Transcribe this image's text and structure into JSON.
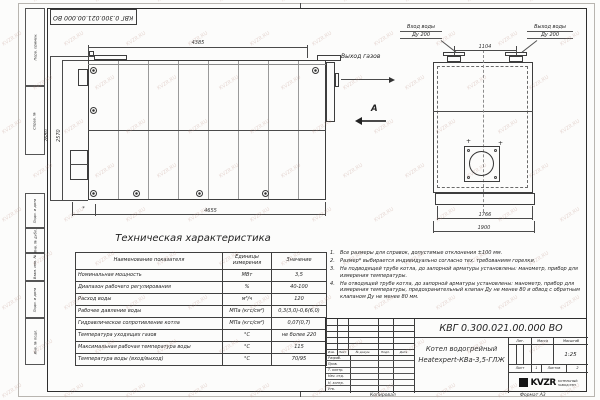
{
  "watermark": "KVZR.RU",
  "frame": {
    "margin_stamps": [
      "Перв. примен.",
      "Справ. №",
      "Подп. и дата",
      "Инв. № дубл.",
      "Взам. инв. №",
      "Подп. и дата",
      "Инв. № подл."
    ],
    "copied_label": "Копировал",
    "format_label": "Формат А3"
  },
  "side_view": {
    "dim_top": "4385",
    "dim_bottom": "4655",
    "dim_star": "*",
    "dim_height_outer": "2680",
    "dim_height_inner": "2570",
    "gas_outlet_label": "Выход газов",
    "view_label": "А"
  },
  "front_view": {
    "water_inlet_line1": "Вход воды",
    "water_inlet_line2": "Ду 200",
    "water_outlet_line1": "Выход воды",
    "water_outlet_line2": "Ду 200",
    "dim_nozzles": "1104",
    "dim_body": "1766",
    "dim_base": "1900",
    "cross_mark": "+"
  },
  "spec": {
    "title": "Техническая характеристика",
    "headers": [
      "Наименование показателя",
      "Единицы измерения",
      "Значение"
    ],
    "rows": [
      [
        "Номинальная мощность",
        "МВт",
        "3,5"
      ],
      [
        "Диапазон рабочего регулирования",
        "%",
        "40-100"
      ],
      [
        "Расход воды",
        "м³/ч",
        "120"
      ],
      [
        "Рабочее давление воды",
        "МПа (кгс/см²)",
        "0,3(3,0)-0,6(6,0)"
      ],
      [
        "Гидравлическое сопротивление котла",
        "МПа (кгс/см²)",
        "0,07(0,7)"
      ],
      [
        "Температура уходящих газов",
        "°С",
        "не более 220"
      ],
      [
        "Максимальная рабочая температура воды",
        "°С",
        "115"
      ],
      [
        "Температура воды (вход/выход)",
        "°С",
        "70/95"
      ]
    ]
  },
  "notes": [
    "Все размеры для справок, допустимые отклонения ±100 мм.",
    "Размер* выбирается индивидуально согласно тех. требованиям горелки.",
    "На подводящей трубе котла, до запорной арматуры установлены: манометр, прибор для измерения температуры.",
    "На отводящей трубе котла, до запорной арматуры установлены: манометр, прибор для измерения температуры, предохранительный клапан Ду не менее 80 и обвод с обратным клапаном Ду не менее 80 мм."
  ],
  "title_block": {
    "doc_number": "КВГ 0.300.021.00.000 ВО",
    "product_name_line1": "Котел водогрейный",
    "product_name_line2": "Heatexpert-КВа-3,5-ГЛЖ",
    "rev_cols": [
      "Изм.",
      "Лист",
      "№ докум.",
      "Подп.",
      "Дата"
    ],
    "roles": [
      "Разраб.",
      "Пров.",
      "Т. контр.",
      "Нач. отд.",
      "Н. контр.",
      "Утв."
    ],
    "lit_label": "Лит.",
    "mass_label": "Масса",
    "scale_label": "Масштаб",
    "scale_value": "1:25",
    "sheet_label": "Лист",
    "sheet_value": "1",
    "sheets_label": "Листов",
    "sheets_value": "2",
    "logo_text": "KVZR",
    "logo_sub1": "КОТЕЛЬНЫЙ",
    "logo_sub2": "ЗАВОД РЭП"
  }
}
